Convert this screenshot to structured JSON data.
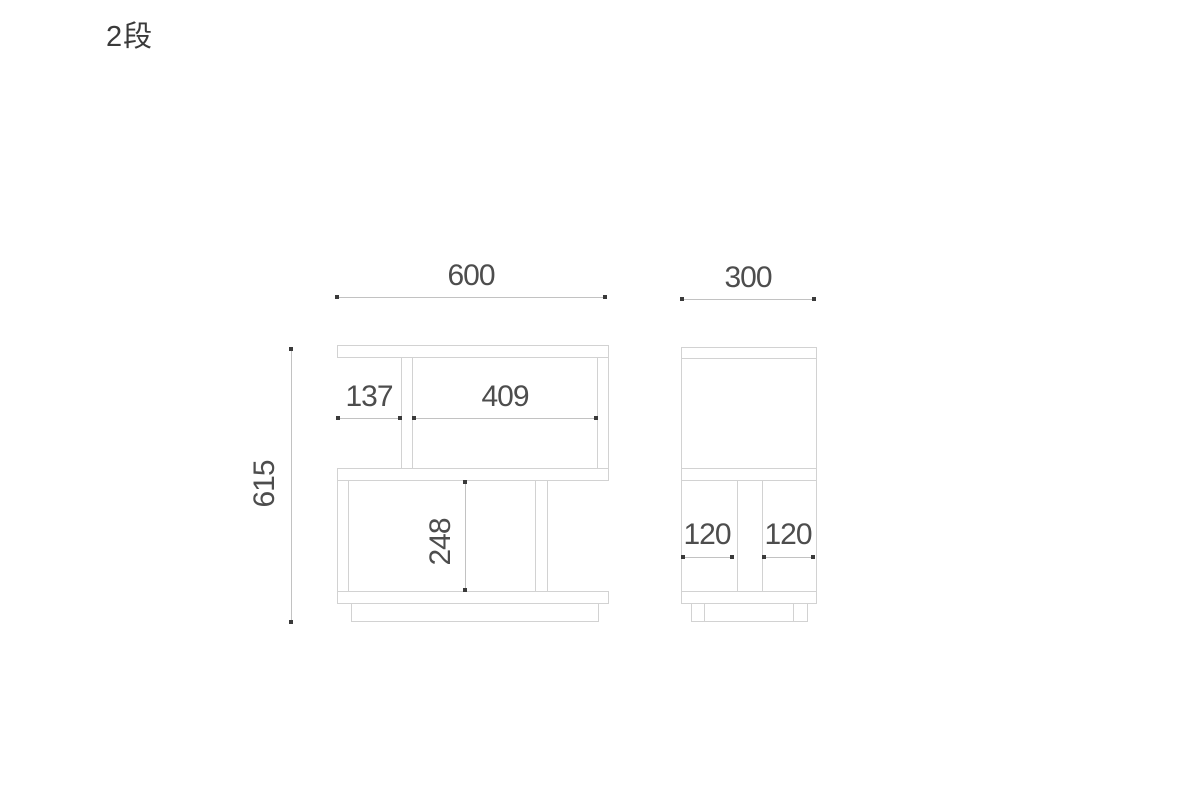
{
  "title": "2段",
  "drawing": {
    "description": "Two-tier zig-zag shelf dimension diagram with front view and side view",
    "front_view": {
      "width": "600",
      "height": "615",
      "top_shelf_left_section": "137",
      "top_shelf_right_section": "409",
      "bottom_shelf_inner_height": "248"
    },
    "side_view": {
      "depth": "300",
      "bottom_left_section": "120",
      "bottom_right_section": "120"
    }
  },
  "colors": {
    "structure_line": "#d2d2d2",
    "dimension_line": "#c2c2c2",
    "dimension_dot": "#3a3a3a",
    "dimension_text": "#4d4d4d",
    "title_text": "#3a3a3a",
    "background": "#ffffff"
  }
}
